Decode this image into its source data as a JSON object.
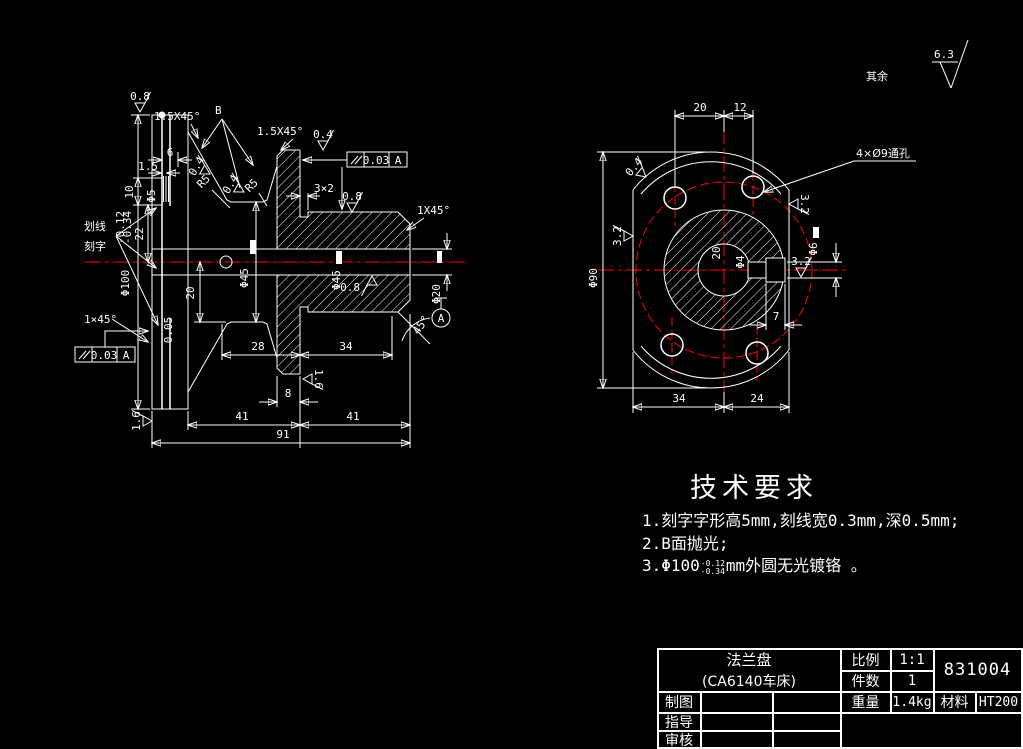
{
  "canvas": {
    "bg": "#000000",
    "line_color": "#ffffff",
    "centerline_color": "#ff0000"
  },
  "corner": {
    "label": "其余",
    "value": "6.3"
  },
  "lv": {
    "b": "B",
    "huaxian": "划线",
    "kezi": "刻字",
    "c_tl": "1.5X45°",
    "c_collar": "1.5X45°",
    "c_r": "1X45°",
    "c_bl": "1×45°",
    "groove": "3×2",
    "angle": "45°",
    "datum": "A",
    "r5a": "R5",
    "r5b": "R5",
    "ra_tl": "0.8",
    "ra_cone_l": "0.4",
    "ra_cone_r": "0.4",
    "ra_collar": "0.4",
    "ra_cyl": "0.8",
    "ra_bore": "0.8",
    "ra_collar_b": "1.6",
    "ra_left_b": "1.6",
    "flat": "0.05",
    "gdt_top": {
      "val": "0.03",
      "datum": "A"
    },
    "gdt_bot": {
      "val": "0.03",
      "datum": "A"
    },
    "d6": "6",
    "d15": "1.5",
    "d10": "10",
    "phi5": "Φ5",
    "d22": "22",
    "d20": "20",
    "phi100": "Φ100",
    "phi100_tu": "-0.12",
    "phi100_tl": "-0.34",
    "phi45a": "Φ45",
    "phi45b": "Φ45",
    "phi20": "Φ20",
    "d28": "28",
    "d34": "34",
    "d8": "8",
    "d41l": "41",
    "d41r": "41",
    "d91": "91"
  },
  "rv": {
    "d20": "20",
    "d12": "12",
    "d34": "34",
    "d24": "24",
    "d7": "7",
    "phi90": "Φ90",
    "phi6": "Φ6",
    "phi4": "Φ4",
    "bore": "20",
    "holes": "4×Ø9通孔",
    "ra_left": "3.2",
    "ra_key": "3.2",
    "ra_right": "3.2",
    "ra_top": "0.4"
  },
  "tech": {
    "title": "技术要求",
    "i1": "1.刻字字形高5mm,刻线宽0.3mm,深0.5mm;",
    "i2": "2.B面抛光;",
    "i3a": "3.Φ100",
    "i3_tu": "-0.12",
    "i3_tl": "-0.34",
    "i3b": "mm外圆无光镀铬 。"
  },
  "tb": {
    "name": "法兰盘",
    "sub": "(CA6140车床)",
    "scale_l": "比例",
    "scale": "1:1",
    "qty_l": "件数",
    "qty": "1",
    "no": "831004",
    "weight_l": "重量",
    "weight": "1.4kg",
    "mat_l": "材料",
    "mat": "HT200",
    "r1": "制图",
    "r2": "指导",
    "r3": "审核"
  }
}
